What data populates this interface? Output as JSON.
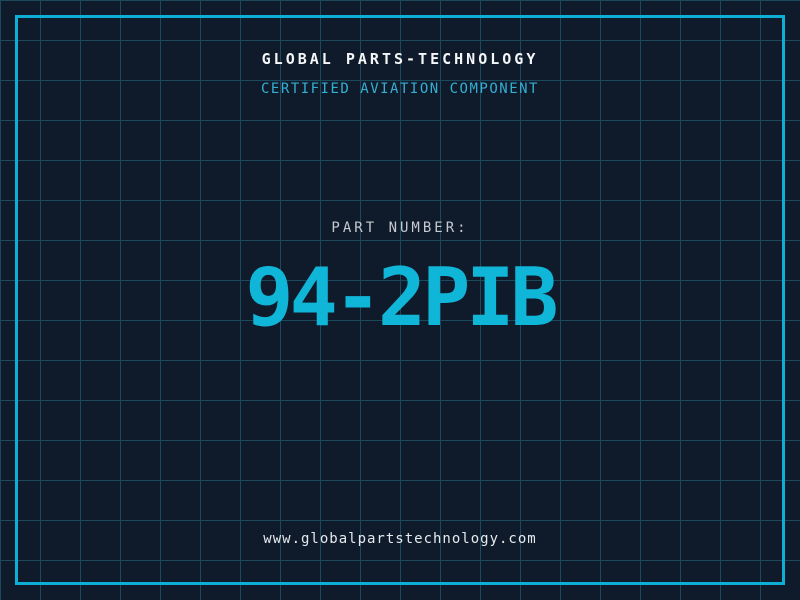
{
  "header": {
    "title": "GLOBAL PARTS-TECHNOLOGY",
    "subtitle": "CERTIFIED AVIATION COMPONENT"
  },
  "part": {
    "label": "PART NUMBER:",
    "number": "94-2PIB"
  },
  "footer": {
    "url": "www.globalpartstechnology.com"
  },
  "colors": {
    "background": "#0f1b2b",
    "grid_line": "#1b4a5e",
    "border": "#0db0d4",
    "title_text": "#f4f6f8",
    "subtitle_text": "#35aed3",
    "label_text": "#c6cad1",
    "part_number_text": "#10b6d8",
    "footer_text": "#e6eaee"
  }
}
